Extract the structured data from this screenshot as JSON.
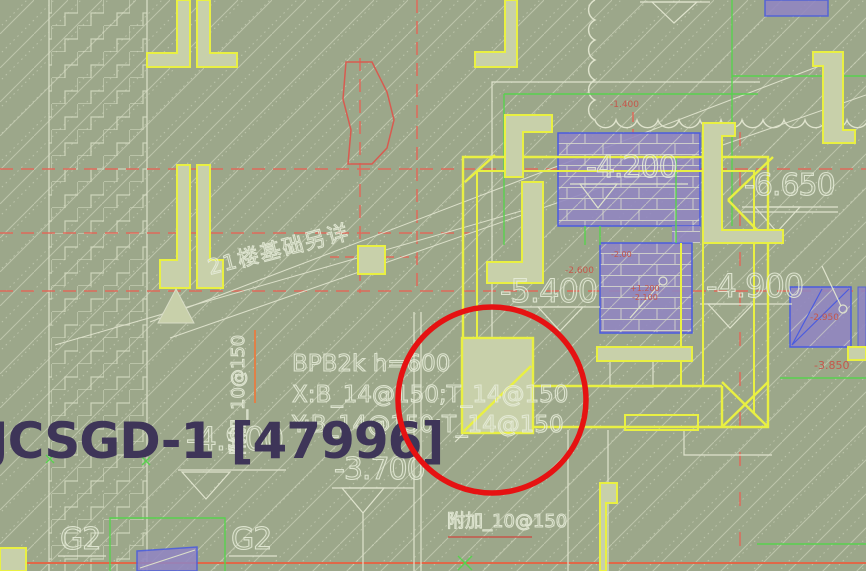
{
  "drawing": {
    "type": "structural-foundation-plan",
    "title_label": "JCSGD-1 [47996]",
    "elevations": {
      "e_4200": "-4.200",
      "e_6650": "-6.650",
      "e_5400": "-5.400",
      "e_4900": "-4.900",
      "e_4900_ghost": "-4.900",
      "e_3700": "-3.700"
    },
    "slab_note": {
      "line1": "BPB2k h=600",
      "line2": "X:B_14@150;T_14@150",
      "line3": "Y:B_14@150;T_14@150"
    },
    "rebar_notes": {
      "vertical": "附加_10@150",
      "horizontal": "附加_10@150"
    },
    "beam_labels": {
      "g2_left": "G2",
      "g2_right": "G2"
    },
    "diagonal_note": "21楼基础另详",
    "red_annotations": {
      "r_1400": "-1.400",
      "r_2600": "-2.600",
      "r_200": "-2.00",
      "r_p1200": "+1.200",
      "r_2100": "-2.100",
      "r_2950": "-2.950",
      "r_3850": "-3.850"
    },
    "colors": {
      "background": "#9CA78A",
      "linework_white": "#DFE3CD",
      "highlight_yellow": "#E9F042",
      "grid_red": "#DE6A5A",
      "annotation_red": "#E61212",
      "hatch_purple": "#9185C2",
      "outline_blue": "#4A5BE0",
      "green": "#58D24E",
      "fill_olive": "#C8D0AA",
      "title_text": "#3E3558"
    }
  }
}
